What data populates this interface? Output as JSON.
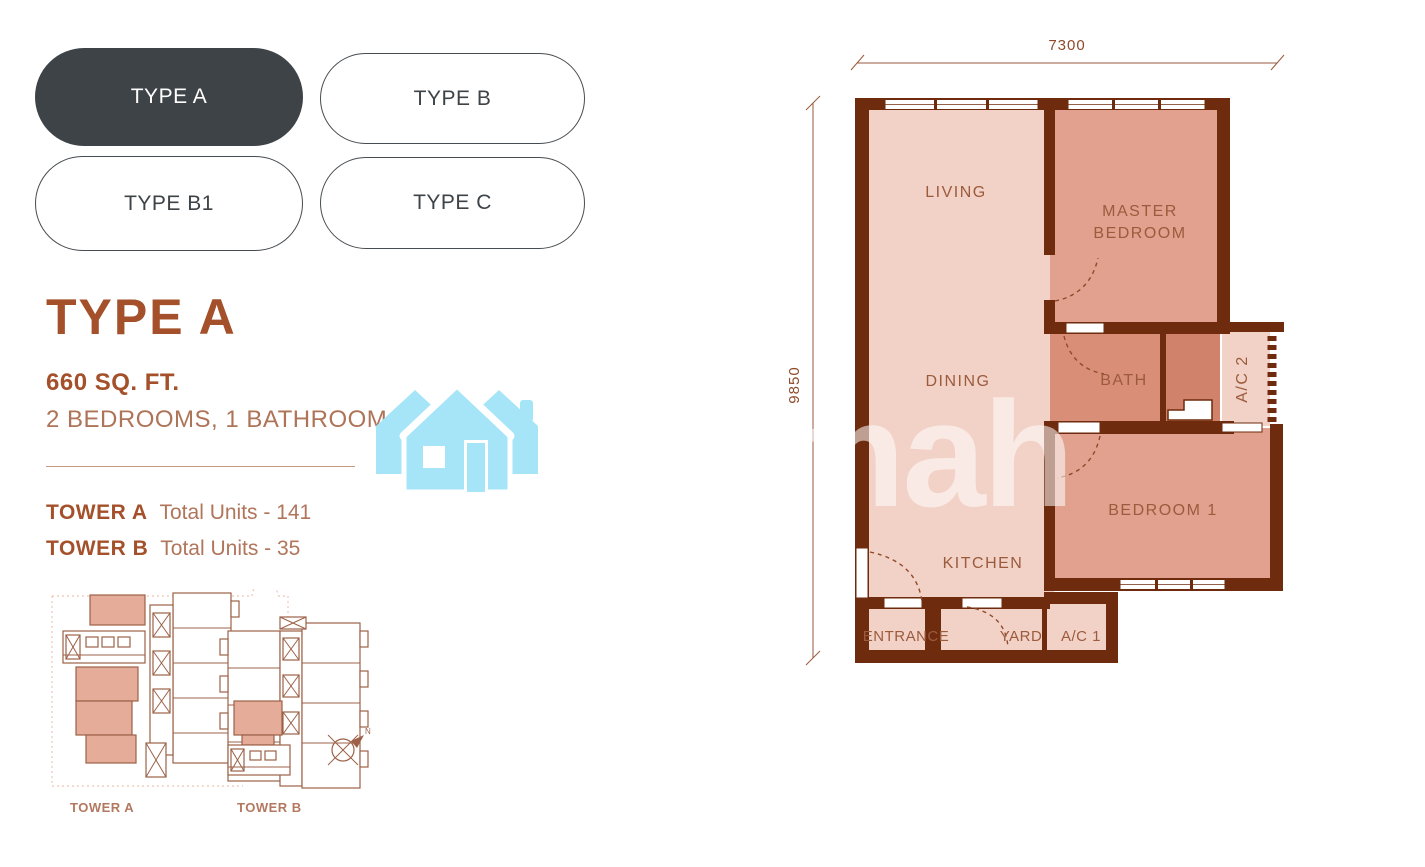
{
  "type_buttons": [
    {
      "label": "TYPE A",
      "selected": true
    },
    {
      "label": "TYPE B",
      "selected": false
    },
    {
      "label": "TYPE B1",
      "selected": false
    },
    {
      "label": "TYPE C",
      "selected": false
    }
  ],
  "details": {
    "title": "TYPE A",
    "area": "660 SQ. FT.",
    "config": "2 BEDROOMS, 1 BATHROOM"
  },
  "towers": [
    {
      "name": "TOWER A",
      "units": "Total Units - 141"
    },
    {
      "name": "TOWER B",
      "units": "Total Units - 35"
    }
  ],
  "site_plan": {
    "tower_a_label": "TOWER A",
    "tower_b_label": "TOWER B",
    "compass": "N"
  },
  "floor_plan": {
    "dim_top": "7300",
    "dim_left": "9850",
    "rooms": {
      "living": "LIVING",
      "master": [
        "MASTER",
        "BEDROOM"
      ],
      "dining": "DINING",
      "bath": "BATH",
      "ac2": "A/C 2",
      "bedroom1": "BEDROOM 1",
      "kitchen": "KITCHEN",
      "entrance": "ENTRANCE",
      "yard": "YARD",
      "ac1": "A/C 1"
    }
  },
  "watermark": {
    "text": "mah"
  },
  "colors": {
    "selected_pill": "#3d4347",
    "accent_brown": "#a4512b",
    "wall_brown": "#6f2b0d",
    "room_light": "#f2d1c6",
    "room_salmon": "#e1a18e",
    "room_bath": "#d98f77",
    "watermark_cyan": "#a6e5f8"
  }
}
